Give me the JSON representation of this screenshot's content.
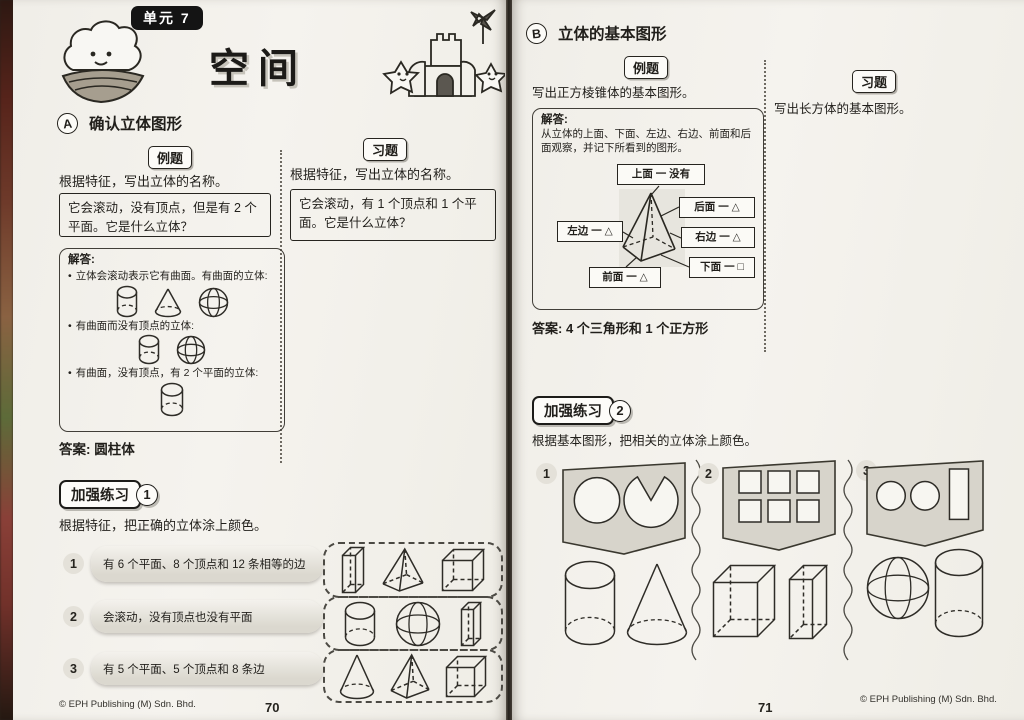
{
  "colors": {
    "paper": "#f4f2ed",
    "ink": "#26241f",
    "panel_gray": "#d7d4cb",
    "badge_black": "#141414"
  },
  "left_page": {
    "unit_badge": "单元 7",
    "title": "空间",
    "section": {
      "letter": "A",
      "title": "确认立体图形"
    },
    "example": {
      "badge": "例题",
      "instruction": "根据特征，写出立体的名称。",
      "question": "它会滚动，没有顶点，但是有 2 个平面。它是什么立体？",
      "solution_label": "解答:",
      "bullets": [
        {
          "text": "立体会滚动表示它有曲面。有曲面的立体:",
          "shapes": [
            "cylinder",
            "cone",
            "sphere"
          ]
        },
        {
          "text": "有曲面而没有顶点的立体:",
          "shapes": [
            "cylinder",
            "sphere"
          ]
        },
        {
          "text": "有曲面，没有顶点，有 2 个平面的立体:",
          "shapes": [
            "cylinder"
          ]
        }
      ],
      "answer_label": "答案:",
      "answer": "圆柱体"
    },
    "exercise": {
      "badge": "习题",
      "instruction": "根据特征，写出立体的名称。",
      "question": "它会滚动，有 1 个顶点和 1 个平面。它是什么立体？"
    },
    "practice": {
      "badge": "加强练习",
      "number": "1",
      "instruction": "根据特征，把正确的立体涂上颜色。",
      "rows": [
        {
          "num": "1",
          "text": "有 6 个平面、8 个顶点和 12 条相等的边",
          "shapes": [
            "cuboid",
            "pyramid",
            "cube"
          ]
        },
        {
          "num": "2",
          "text": "会滚动，没有顶点也没有平面",
          "shapes": [
            "cylinder",
            "sphere",
            "cuboid"
          ]
        },
        {
          "num": "3",
          "text": "有 5 个平面、5 个顶点和 8 条边",
          "shapes": [
            "cone",
            "pyramid",
            "cube"
          ]
        }
      ]
    },
    "footer": {
      "copyright": "© EPH Publishing (M) Sdn. Bhd.",
      "page": "70"
    }
  },
  "right_page": {
    "section": {
      "letter": "B",
      "title": "立体的基本图形"
    },
    "example": {
      "badge": "例题",
      "instruction": "写出正方棱锥体的基本图形。",
      "solution_label": "解答:",
      "solution_text": "从立体的上面、下面、左边、右边、前面和后面观察，并记下所看到的图形。",
      "labels": {
        "top": "上面 一 没有",
        "back": "后面 一 △",
        "left": "左边 一 △",
        "right": "右边 一 △",
        "front": "前面 一 △",
        "bottom": "下面 一 □"
      },
      "answer_label": "答案:",
      "answer": "4 个三角形和 1 个正方形"
    },
    "exercise": {
      "badge": "习题",
      "instruction": "写出长方体的基本图形。"
    },
    "practice": {
      "badge": "加强练习",
      "number": "2",
      "instruction": "根据基本图形，把相关的立体涂上颜色。",
      "columns": [
        {
          "num": "1",
          "panel": [
            "circle",
            "pacman"
          ],
          "solids": [
            "cylinder",
            "cone"
          ]
        },
        {
          "num": "2",
          "panel": [
            "six-squares"
          ],
          "solids": [
            "cube",
            "cuboid"
          ]
        },
        {
          "num": "3",
          "panel": [
            "circle",
            "circle",
            "rectangle"
          ],
          "solids": [
            "sphere",
            "cylinder"
          ]
        }
      ]
    },
    "footer": {
      "page": "71",
      "copyright": "© EPH Publishing (M) Sdn. Bhd."
    }
  }
}
